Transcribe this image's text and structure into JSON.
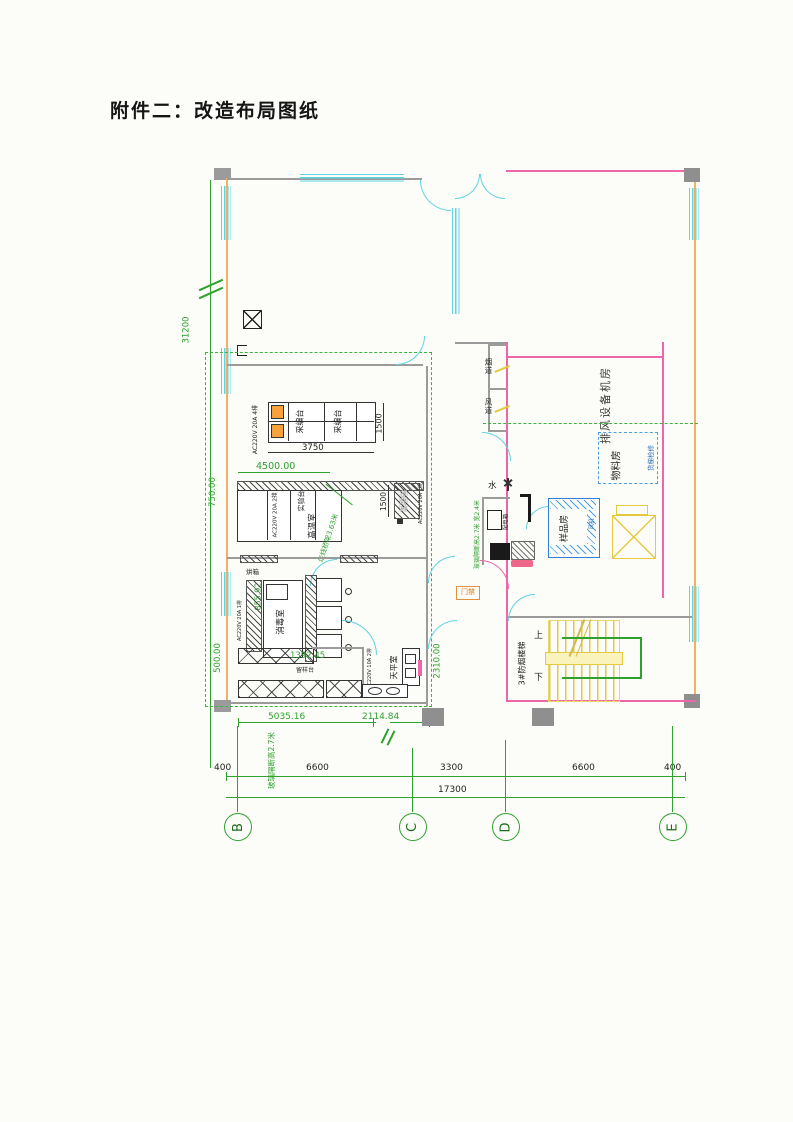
{
  "page": {
    "title": "附件二：改造布局图纸"
  },
  "colors": {
    "dimension_green": "#2fa12f",
    "wall_orange": "#f2b066",
    "window_cyan": "#5fd3e0",
    "wall_pink": "#ee66aa",
    "stair_yellow": "#e5c93f",
    "scope_dash_green": "#3cb43c",
    "equipment_blue": "#2f7fd4"
  },
  "plan": {
    "overall_height_dim": "31200",
    "grid": {
      "bubbles": [
        "B",
        "C",
        "D",
        "E"
      ]
    },
    "dims": {
      "row": [
        "400",
        "6600",
        "3300",
        "6600",
        "400"
      ],
      "total": "17300",
      "table_width": "3750",
      "table_depth": "1500",
      "bench_depth": "1500",
      "d4500": "4500.00",
      "d750": "750.00",
      "d500": "500.00",
      "d855": "855.92",
      "d1392": "1392.45",
      "d2310": "2310.00",
      "d5035": "5035.16",
      "d2114": "2114.84"
    },
    "notes": {
      "cable_tray": "走线桥架3.63米",
      "glass_partition": "玻璃隔断高2.7米",
      "glass_partition_small": "玻璃隔断高2.7米 宽2.4米"
    },
    "labels": {
      "desk": "采编台",
      "desk2": "采编台",
      "power_4": "AC220V 20A 4排",
      "power_2": "AC220V 20A 2排",
      "power_1": "AC220V 20A 1排",
      "power_10a": "AC220V 10A 2排",
      "bench": "实验台",
      "bench2": "实验台",
      "room_high_temp": "高温室",
      "room_disinfect": "消毒室",
      "oven": "烘箱",
      "sample_table": "留样台",
      "room_balance": "天平室",
      "flue": "烟道",
      "air_duct": "风道",
      "exhaust_room": "排风设备机房",
      "material_room": "物料房",
      "freight_elev": "货梯检修",
      "sample_room": "样品房",
      "fan": "风机",
      "power_box": "配电箱",
      "water": "水",
      "access": "门禁",
      "stair": "3#防烟楼梯",
      "up": "上",
      "down": "下"
    }
  }
}
